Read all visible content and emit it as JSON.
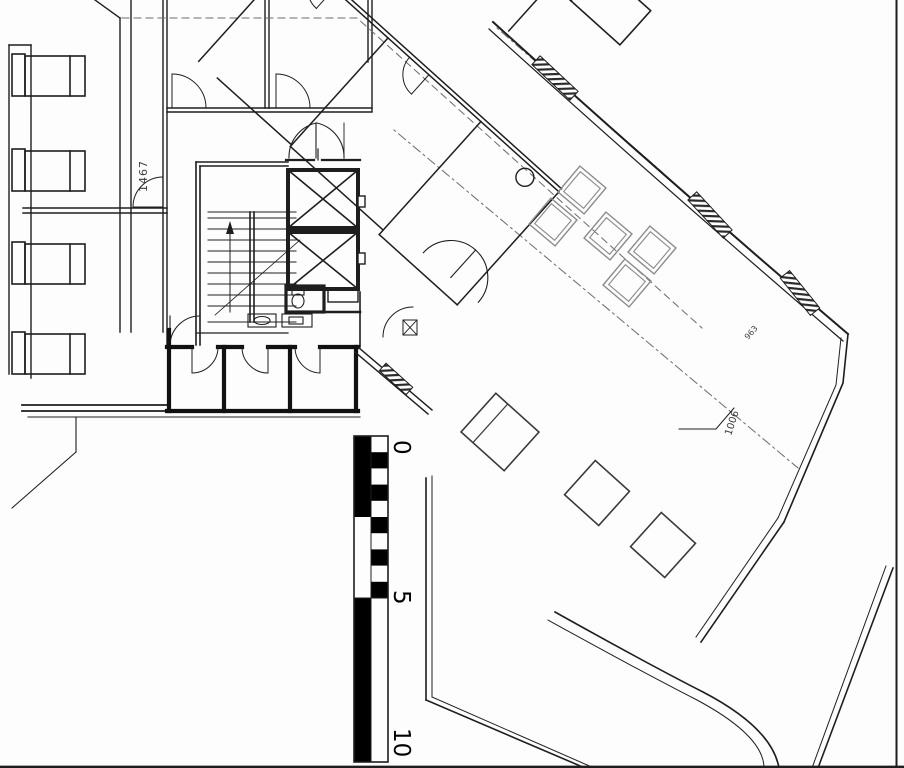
{
  "plan": {
    "annotations": {
      "left_dimension": "1467",
      "mid_dimension": "963",
      "room_dimension": "1006"
    },
    "scale_bar": {
      "tick_0": "0",
      "tick_5": "5",
      "tick_10": "10"
    },
    "colors": {
      "wall": "#1e1e1e",
      "furniture_gray": "#8a8a8a",
      "background": "#fdfdfd",
      "scale_black": "#000000"
    }
  }
}
